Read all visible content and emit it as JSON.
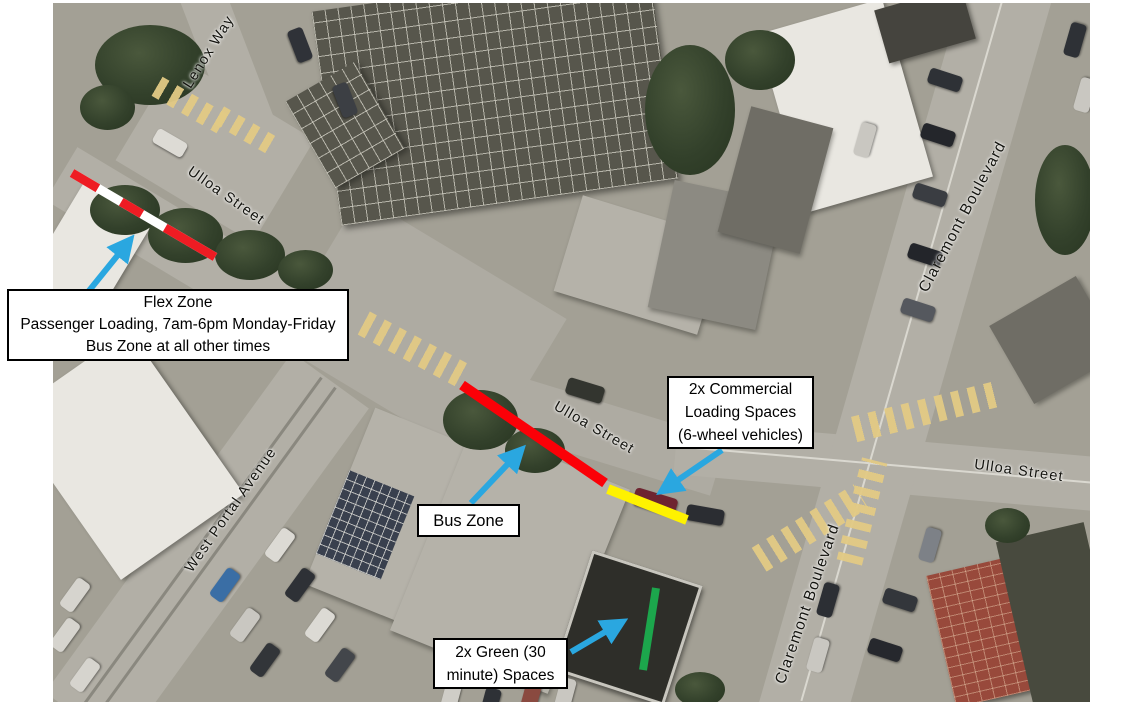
{
  "map": {
    "streets": {
      "lenox": "Lenox Way",
      "ulloa_nw": "Ulloa Street",
      "ulloa_mid": "Ulloa Street",
      "ulloa_east": "Ulloa Street",
      "west_portal": "West Portal Avenue",
      "claremont_north": "Claremont Boulevard",
      "claremont_south": "Claremont Boulevard"
    },
    "callouts": {
      "flex": {
        "line1": "Flex Zone",
        "line2": "Passenger Loading, 7am-6pm Monday-Friday",
        "line3": "Bus Zone at all other times"
      },
      "commercial": {
        "line1": "2x Commercial",
        "line2": "Loading Spaces",
        "line3": "(6-wheel vehicles)"
      },
      "bus": {
        "line1": "Bus Zone"
      },
      "green": {
        "line1": "2x Green (30",
        "line2": "minute) Spaces"
      }
    },
    "markings": {
      "flex_zone": {
        "pattern": "red-white dashed",
        "red": "#ee1c23",
        "white": "#ffffff"
      },
      "bus_zone": {
        "color": "#fb0007"
      },
      "commercial_loading": {
        "color": "#fef200"
      },
      "green_spaces": {
        "color": "#1ca64c"
      },
      "arrow": {
        "color": "#2aa7e0"
      }
    }
  }
}
